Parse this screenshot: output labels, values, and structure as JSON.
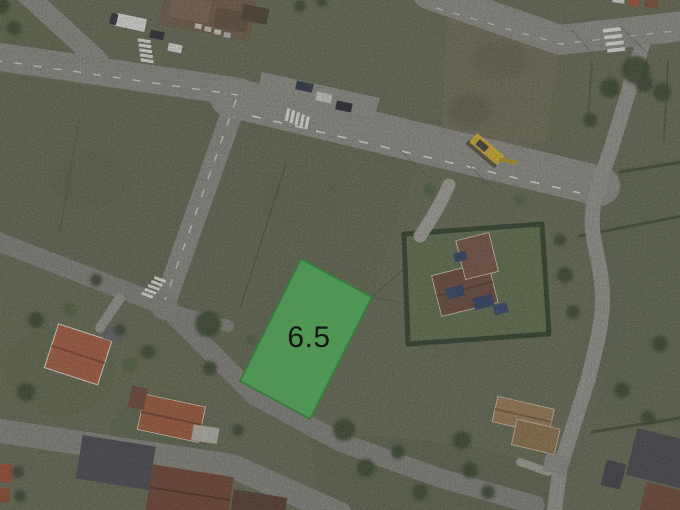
{
  "parcel": {
    "area_label": "6.5",
    "fill_color": "#4f9a55",
    "border_color": "#3a7b41",
    "label_color": "#161616"
  },
  "scene": {
    "base_grass_color": "#63654c",
    "road_color": "#8d8c84",
    "brown_field_color": "#776a56",
    "hedge_color": "#35432c",
    "red_roof_color": "#a85a3c"
  }
}
